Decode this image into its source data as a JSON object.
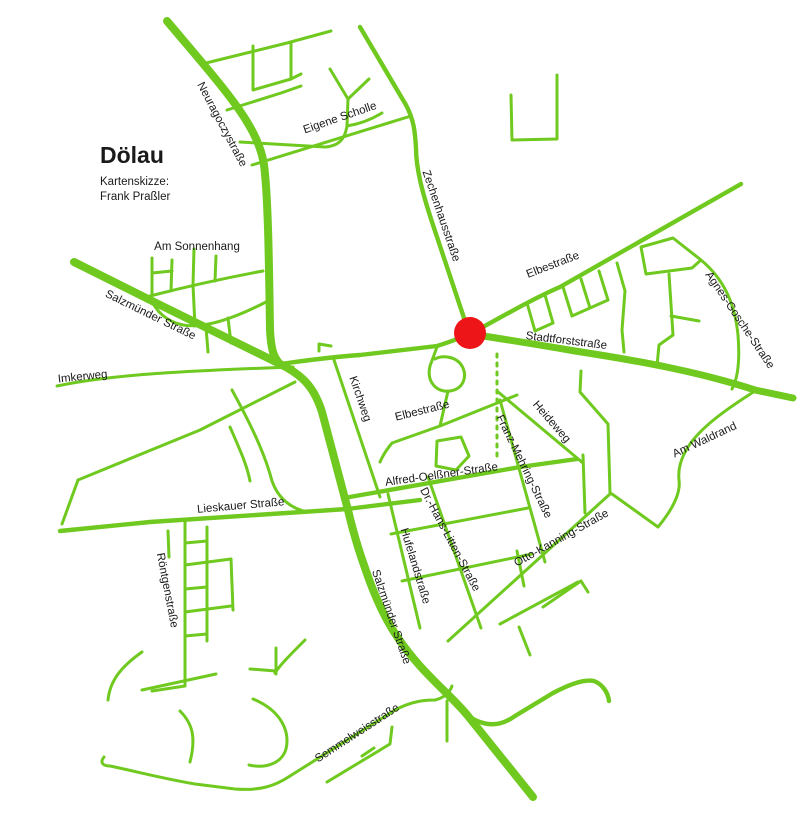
{
  "title": {
    "name": "Dölau",
    "subtitle_line1": "Kartenskizze:",
    "subtitle_line2": "Frank Praßler"
  },
  "colors": {
    "road_green": "#6fc91f",
    "marker_red": "#ed1518",
    "label_black": "#1a1a1a",
    "background": "#ffffff"
  },
  "marker": {
    "x": 470,
    "y": 333,
    "r": 16
  },
  "dotted_path": {
    "d": "M497,354 L497,462",
    "dash": "3 6",
    "width": 3
  },
  "roads": {
    "thick": [
      "M167,21 C225,90 258,125 264,165 C268,195 269,260 270,330 C271,348 273,357 280,364",
      "M74,262 C140,295 220,335 280,364 C305,376 315,390 322,412 L348,510 C355,540 362,560 370,582 C382,614 395,638 420,666 C440,688 455,700 468,716 L533,797"
    ],
    "mainline": [
      "M470,334 C510,340 540,345 575,351 C640,361 700,372 755,390 L793,398"
    ],
    "medium": [
      "M280,364 C310,360 330,357 360,355 L437,346 C450,342 460,338 470,334",
      "M360,27 L406,105 C414,120 415,132 416,148 C416,168 422,192 433,225 L468,330",
      "M470,334 C500,318 530,300 560,287 L741,184",
      "M60,531 L150,522 L347,509 L420,500",
      "M344,498 L520,467 L577,459",
      "M468,716 C485,727 500,727 515,716 L553,693 C570,684 585,679 594,681 C602,684 608,692 609,701"
    ],
    "thin": [
      "M202,64 L287,43 L331,31",
      "M253,46 L253,90 L291,79 L291,42",
      "M291,79 L301,74",
      "M227,110 L281,93 L301,86",
      "M240,142 L325,147 C340,146 345,138 347,126 L348,99",
      "M348,99 L330,69",
      "M348,99 L369,79",
      "M347,126 C360,124 372,119 382,113",
      "M252,165 L411,116",
      "M511,95 L512,140 L557,139 L557,75",
      "M150,296 C185,287 225,278 263,271",
      "M152,258 L152,295",
      "M172,260 L171,291",
      "M194,249 L193,285",
      "M216,256 L215,281",
      "M152,273 L172,271",
      "M150,296 C155,312 168,322 183,325 C205,329 235,318 266,302",
      "M193,285 L195,326",
      "M228,318 L231,343",
      "M206,327 L208,352",
      "M57,386 C100,377 150,372 293,367",
      "M295,382 L200,430 L78,480",
      "M78,480 L62,524",
      "M333,357 L380,497",
      "M319,351 L319,344 L331,346",
      "M232,390 C255,432 266,458 272,481 C278,498 290,508 307,512",
      "M230,427 C240,450 247,465 250,481",
      "M437,347 L430,366",
      "M430,366 C426,383 438,393 450,391 C463,389 468,377 462,366 C456,356 442,355 435,359",
      "M517,395 L440,426 L392,443 C387,449 383,455 380,462",
      "M448,391 L440,426",
      "M437,441 L461,437 L469,456 L456,470 L436,466 Z",
      "M497,391 L583,463",
      "M581,371 L580,392 L608,424 L610,493",
      "M500,400 L545,562",
      "M583,455 L585,513",
      "M448,641 L610,494",
      "M755,391 C725,410 700,428 688,447 C680,460 678,470 679,480 C681,494 672,510 658,527 L612,494",
      "M391,534 L528,508",
      "M402,581 L532,554",
      "M388,494 L420,628",
      "M428,477 L481,628",
      "M517,551 L524,586",
      "M543,607 L581,581 L588,592",
      "M500,624 L578,582",
      "M519,627 L530,655",
      "M527,303 L535,331",
      "M545,295 L553,323",
      "M563,287 L572,316",
      "M581,279 L590,308",
      "M599,271 L608,300",
      "M617,263 L625,291",
      "M535,331 L553,323",
      "M572,316 L590,308 L608,300",
      "M625,291 L622,330 L624,352",
      "M641,247 L673,238 L701,260 L692,268 L646,274 Z",
      "M669,274 L673,335",
      "M671,316 L699,321",
      "M673,335 L659,345 L657,366",
      "M701,260 C725,280 735,305 738,335 C740,360 738,378 732,389",
      "M185,519 L185,686",
      "M207,527 L207,641",
      "M185,543 L207,541",
      "M185,565 L231,559",
      "M185,589 L207,587",
      "M185,612 L231,606",
      "M185,636 L207,634",
      "M231,559 L233,610",
      "M185,686 L152,691",
      "M168,531 L169,557",
      "M142,652 C122,666 110,680 108,700",
      "M142,690 L216,674",
      "M180,711 C193,724 196,738 190,762",
      "M253,699 C282,711 290,732 286,749 C282,763 266,769 249,765",
      "M276,648 L276,674",
      "M250,669 L276,671",
      "M305,640 C290,655 280,665 275,673",
      "M104,757 C100,762 102,766 110,766 C130,770 160,778 195,784 L235,789 C260,791 275,786 290,776 L395,710 C412,701 425,700 435,700 C444,698 450,692 452,686",
      "M327,782 L390,744 L392,727",
      "M374,748 L362,756",
      "M447,701 L447,741"
    ]
  },
  "street_labels": [
    {
      "text": "Neuragoczystraße",
      "x": 219,
      "y": 126,
      "rotate": 62
    },
    {
      "text": "Eigene Scholle",
      "x": 341,
      "y": 121,
      "rotate": -19
    },
    {
      "text": "Zechenhausstraße",
      "x": 438,
      "y": 217,
      "rotate": 71
    },
    {
      "text": "Am Sonnenhang",
      "x": 197,
      "y": 250,
      "rotate": 0
    },
    {
      "text": "Salzmünder Straße",
      "x": 149,
      "y": 318,
      "rotate": 26
    },
    {
      "text": "Imkerweg",
      "x": 83,
      "y": 380,
      "rotate": -6
    },
    {
      "text": "Elbestraße",
      "x": 554,
      "y": 268,
      "rotate": -21
    },
    {
      "text": "Stadtforststraße",
      "x": 566,
      "y": 344,
      "rotate": 7
    },
    {
      "text": "Agnes-Gosche-Straße",
      "x": 737,
      "y": 322,
      "rotate": 56
    },
    {
      "text": "Kirchweg",
      "x": 357,
      "y": 400,
      "rotate": 71
    },
    {
      "text": "Elbestraße",
      "x": 423,
      "y": 414,
      "rotate": -14
    },
    {
      "text": "Heideweg",
      "x": 549,
      "y": 424,
      "rotate": 49
    },
    {
      "text": "Franz-Mehring-Straße",
      "x": 521,
      "y": 468,
      "rotate": 64
    },
    {
      "text": "Am Waldrand",
      "x": 706,
      "y": 443,
      "rotate": -25
    },
    {
      "text": "Alfred-Oelßner-Straße",
      "x": 442,
      "y": 478,
      "rotate": -8
    },
    {
      "text": "Lieskauer Straße",
      "x": 241,
      "y": 509,
      "rotate": -5
    },
    {
      "text": "Dr.-Hans-Litten-Straße",
      "x": 447,
      "y": 541,
      "rotate": 62
    },
    {
      "text": "Hufelandstraße",
      "x": 412,
      "y": 567,
      "rotate": 73
    },
    {
      "text": "Otto-Kanning-Straße",
      "x": 563,
      "y": 541,
      "rotate": -29
    },
    {
      "text": "Röntgenstraße",
      "x": 164,
      "y": 591,
      "rotate": 79
    },
    {
      "text": "Salzmünder Straße",
      "x": 388,
      "y": 618,
      "rotate": 71
    },
    {
      "text": "Semmelweisstraße",
      "x": 359,
      "y": 736,
      "rotate": -33
    }
  ]
}
